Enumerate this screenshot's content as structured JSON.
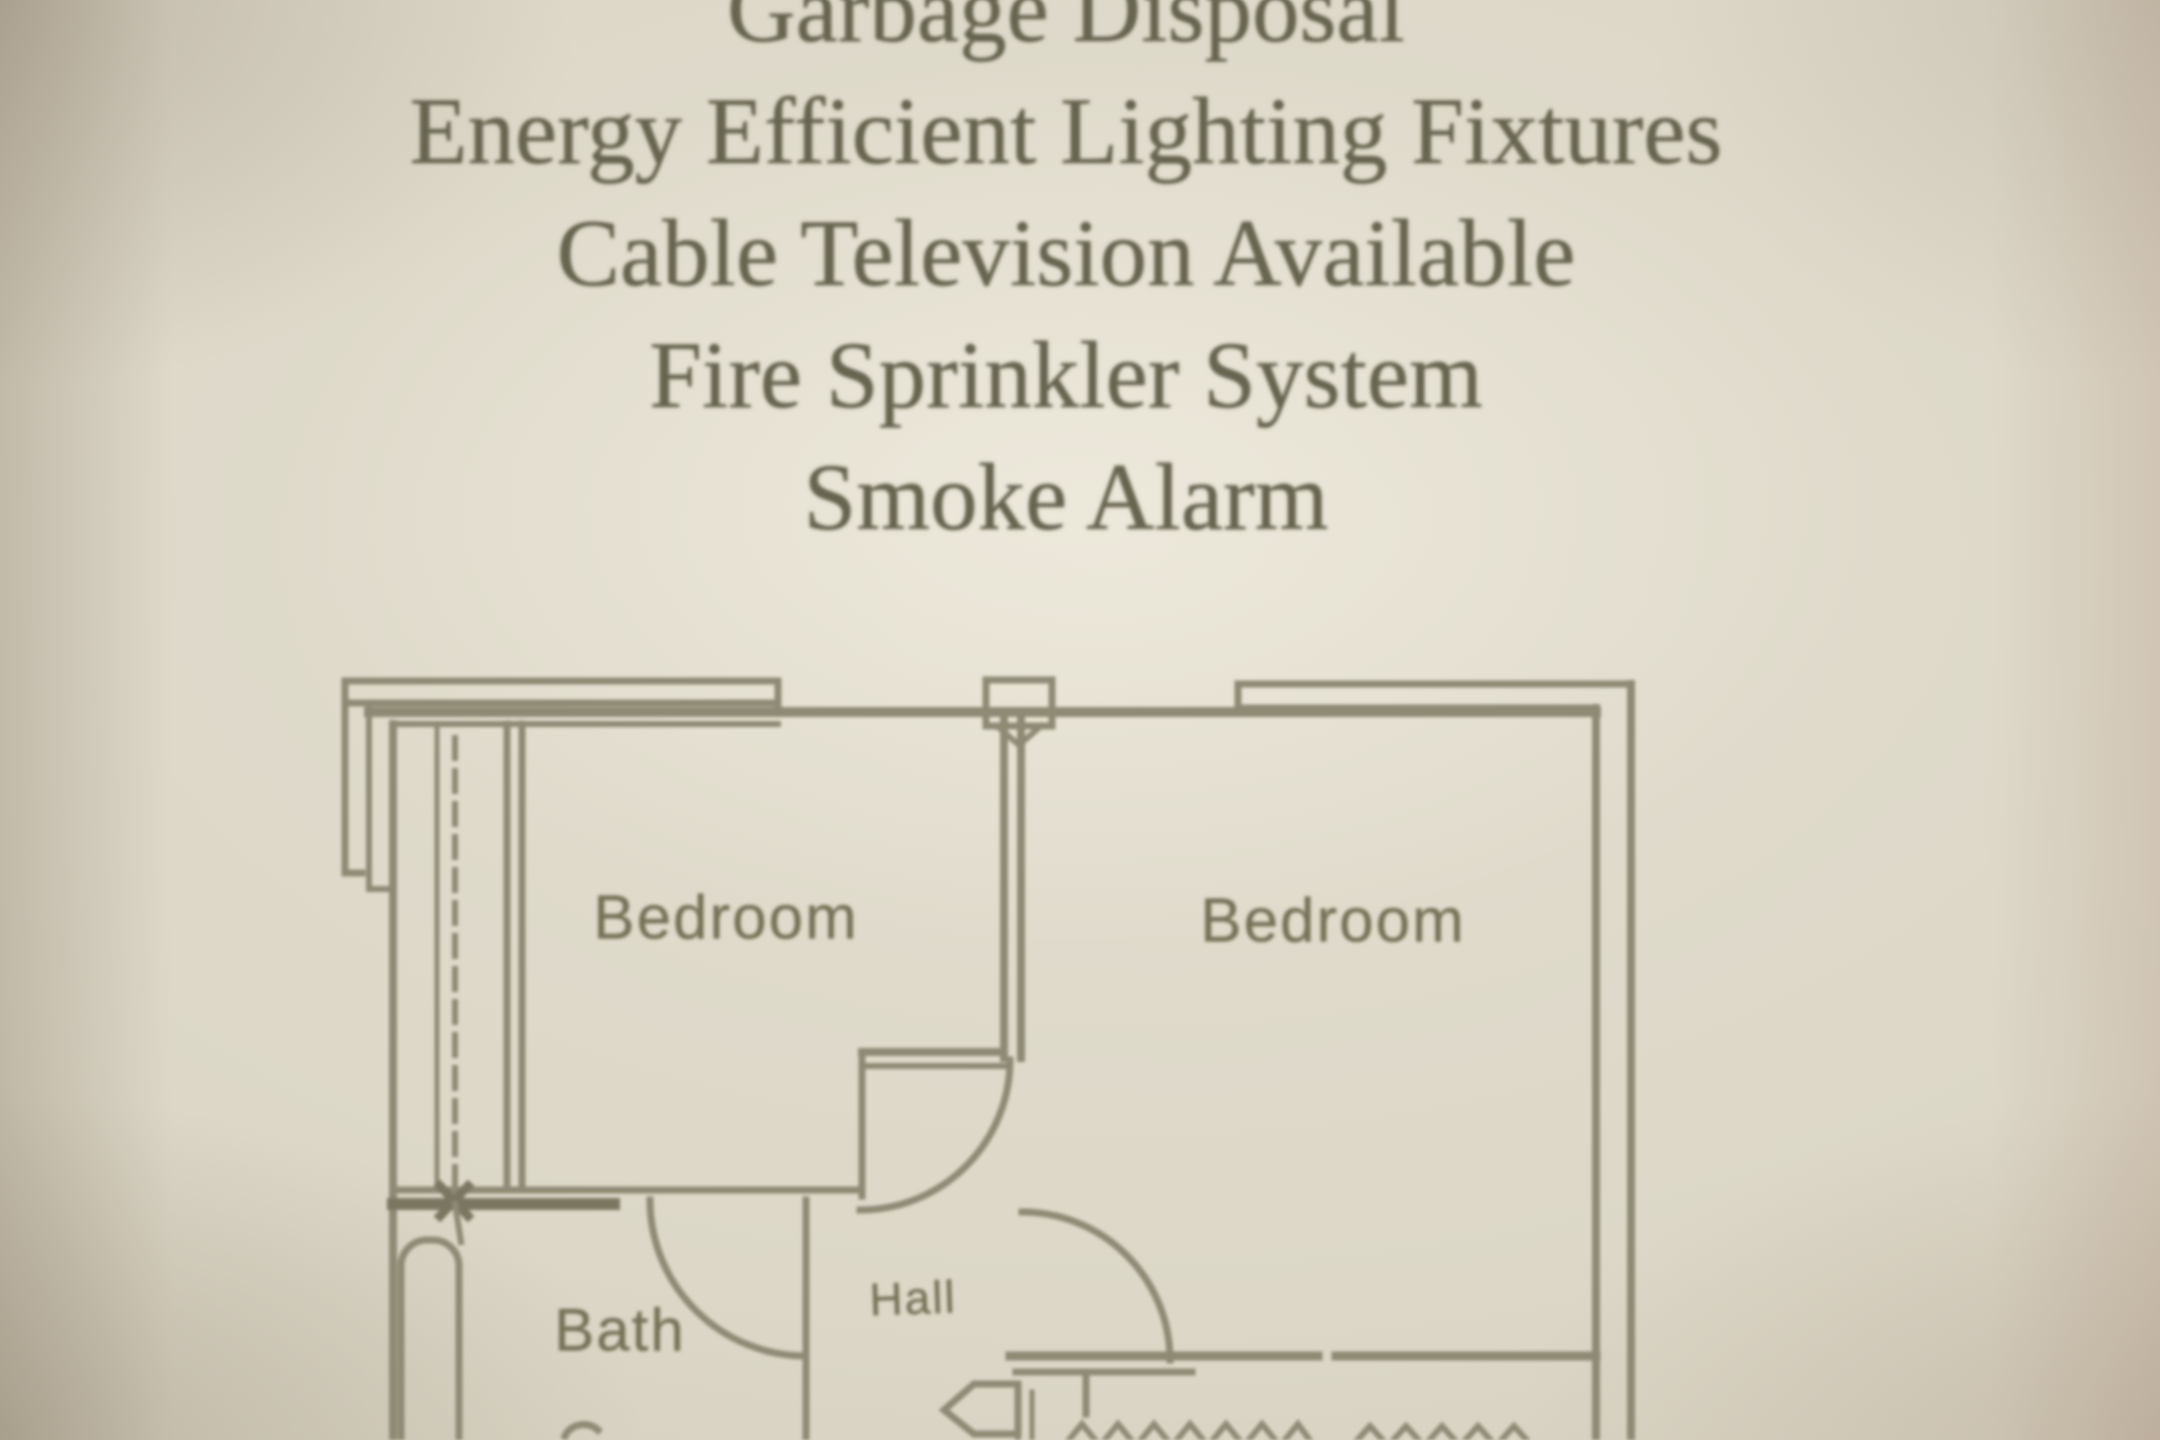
{
  "amenities": {
    "items": [
      "Garbage Disposal",
      "Energy Efficient Lighting Fixtures",
      "Cable Television Available",
      "Fire Sprinkler System",
      "Smoke Alarm"
    ]
  },
  "floor_plan": {
    "labels": {
      "bedroom_left": "Bedroom",
      "bedroom_right": "Bedroom",
      "bath": "Bath",
      "hall": "Hall"
    }
  },
  "colors": {
    "paper": "#dcd7c7",
    "amenity_ink": "#67644f",
    "plan_line": "#8e8a74",
    "plan_line_dark": "#7a7660",
    "label_ink": "#767257"
  }
}
